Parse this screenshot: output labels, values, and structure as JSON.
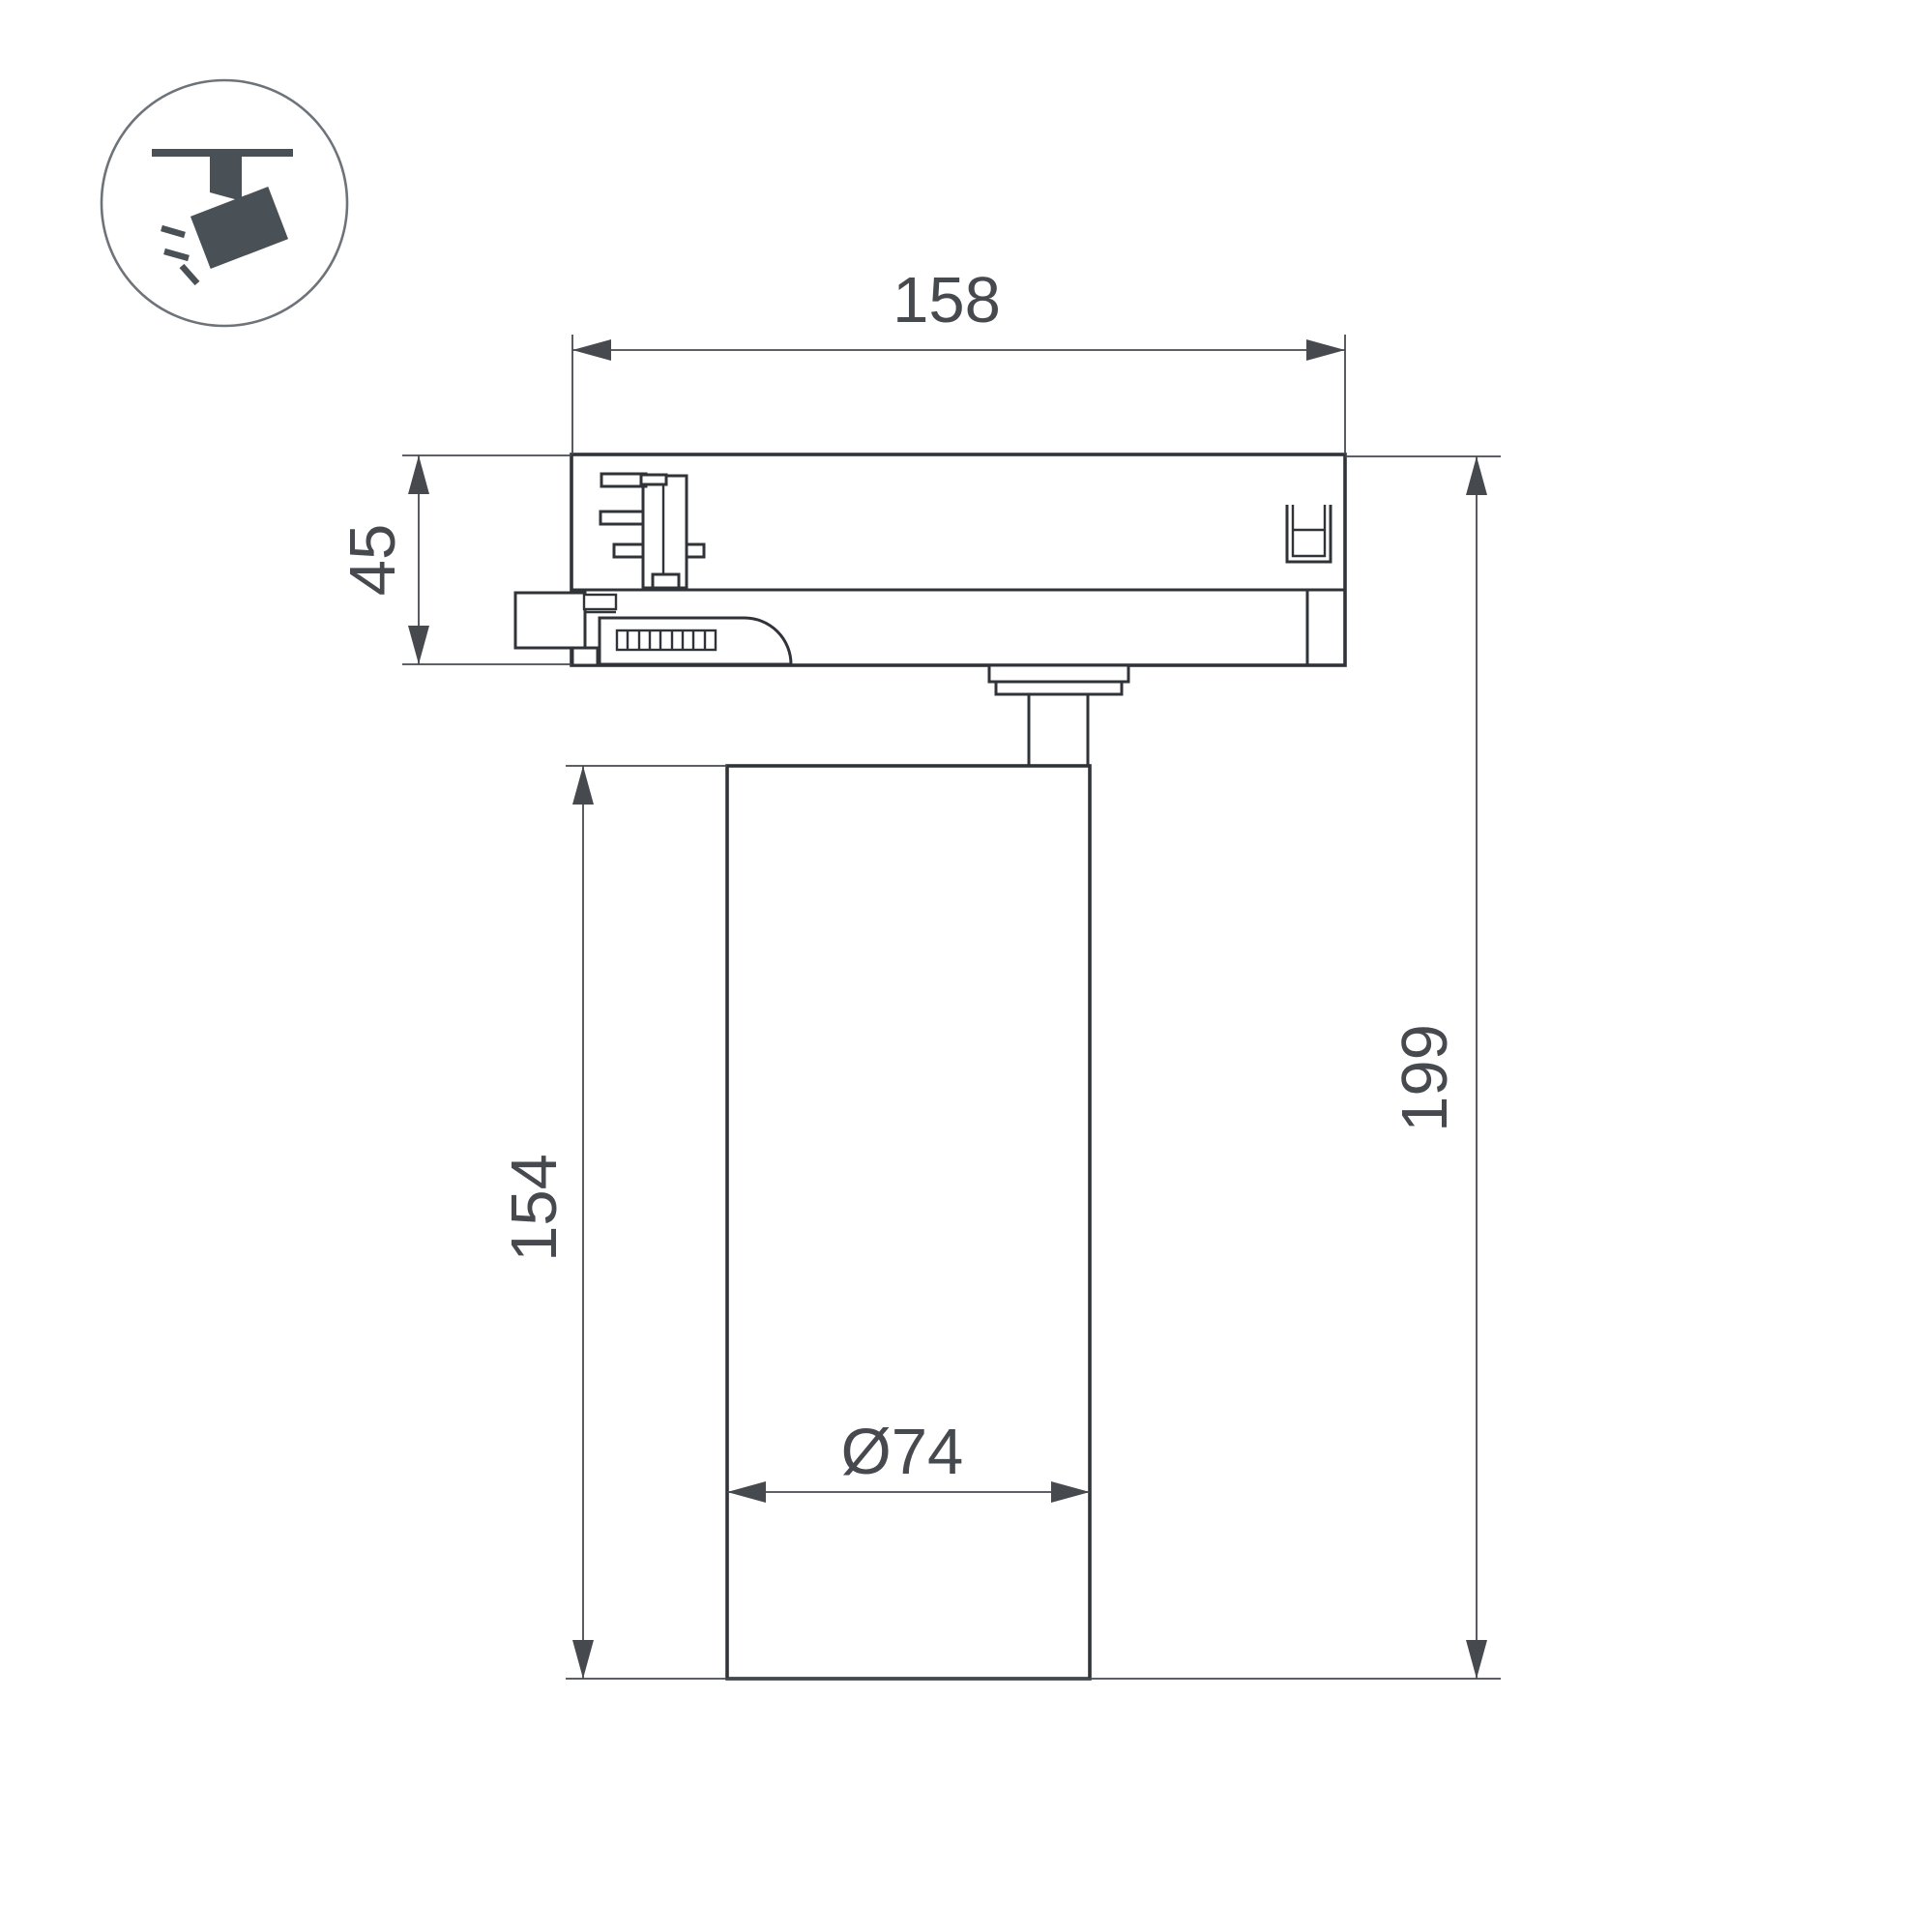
{
  "drawing": {
    "dimensions": {
      "track_adapter_width": "158",
      "track_adapter_height": "45",
      "body_height": "154",
      "overall_height": "199",
      "body_diameter": "Ø74"
    },
    "colors": {
      "object_line": "#303439",
      "dimension_line": "#46494e",
      "icon_fill": "#495056",
      "icon_circle_stroke": "#6d7379",
      "background": "#ffffff"
    },
    "icon": {
      "name": "track-spotlight-icon"
    }
  }
}
